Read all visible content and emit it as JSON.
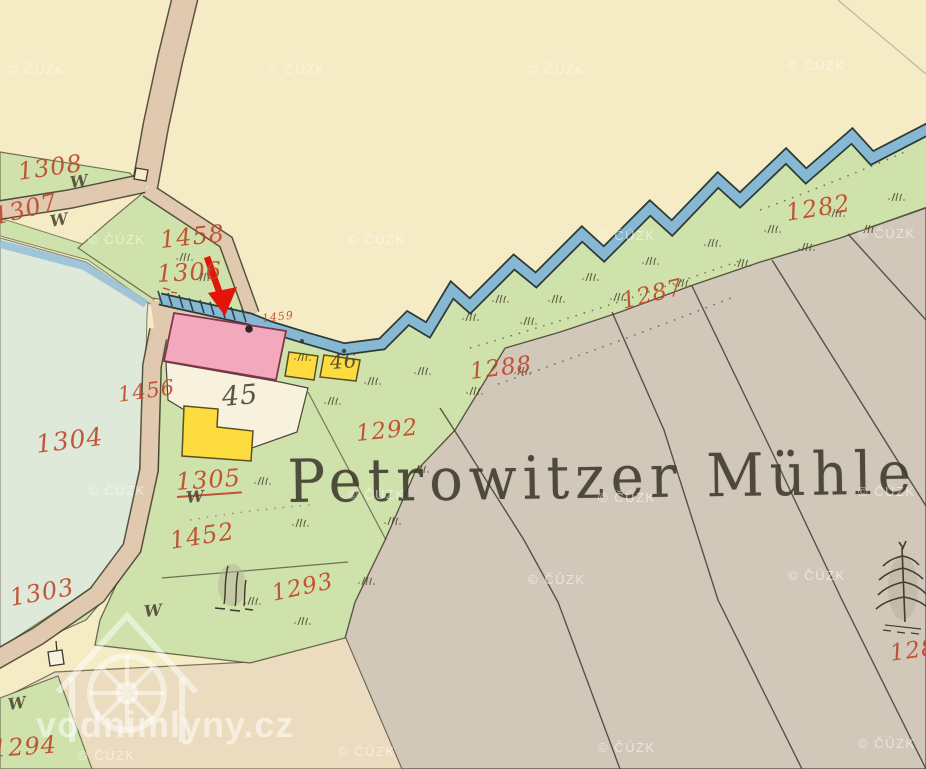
{
  "map": {
    "title_label": "Petrowitzer Mühle",
    "source_watermark": "© ČÚZK",
    "site_watermark": "vodnimlyny.cz",
    "marsh_symbol": "W",
    "parcel_labels": [
      {
        "text": "1308",
        "x": 18,
        "y": 158,
        "rot": -8,
        "size": 24,
        "kind": "red"
      },
      {
        "text": "1307",
        "x": -6,
        "y": 203,
        "rot": -14,
        "size": 24,
        "kind": "red"
      },
      {
        "text": "1458",
        "x": 160,
        "y": 226,
        "rot": -6,
        "size": 24,
        "kind": "red"
      },
      {
        "text": "1306",
        "x": 157,
        "y": 260,
        "rot": -3,
        "size": 24,
        "kind": "red"
      },
      {
        "text": "1459",
        "x": 262,
        "y": 312,
        "rot": -6,
        "size": 11,
        "kind": "red"
      },
      {
        "text": "1456",
        "x": 118,
        "y": 383,
        "rot": -8,
        "size": 21,
        "kind": "red"
      },
      {
        "text": "1304",
        "x": 36,
        "y": 430,
        "rot": -7,
        "size": 25,
        "kind": "red"
      },
      {
        "text": "1305",
        "x": 176,
        "y": 468,
        "rot": -4,
        "size": 24,
        "kind": "red",
        "underline": true
      },
      {
        "text": "1452",
        "x": 170,
        "y": 527,
        "rot": -9,
        "size": 24,
        "kind": "red"
      },
      {
        "text": "1303",
        "x": 10,
        "y": 584,
        "rot": -10,
        "size": 24,
        "kind": "red"
      },
      {
        "text": "1293",
        "x": 272,
        "y": 581,
        "rot": -12,
        "size": 23,
        "kind": "red"
      },
      {
        "text": "1292",
        "x": 356,
        "y": 421,
        "rot": -6,
        "size": 23,
        "kind": "red"
      },
      {
        "text": "1288",
        "x": 470,
        "y": 359,
        "rot": -7,
        "size": 23,
        "kind": "red"
      },
      {
        "text": "1287",
        "x": 622,
        "y": 289,
        "rot": -14,
        "size": 23,
        "kind": "red"
      },
      {
        "text": "1282",
        "x": 786,
        "y": 199,
        "rot": -9,
        "size": 24,
        "kind": "red"
      },
      {
        "text": "128",
        "x": 890,
        "y": 641,
        "rot": -8,
        "size": 23,
        "kind": "red"
      },
      {
        "text": "1294",
        "x": -8,
        "y": 735,
        "rot": -4,
        "size": 24,
        "kind": "red"
      },
      {
        "text": "45",
        "x": 222,
        "y": 382,
        "rot": -5,
        "size": 27,
        "kind": "dark"
      },
      {
        "text": "46",
        "x": 330,
        "y": 350,
        "rot": -4,
        "size": 20,
        "kind": "dark"
      }
    ],
    "marsh_marks": [
      {
        "x": 70,
        "y": 173,
        "rot": -8
      },
      {
        "x": 50,
        "y": 212,
        "rot": -10
      },
      {
        "x": 186,
        "y": 488,
        "rot": -5
      },
      {
        "x": 144,
        "y": 602,
        "rot": -6
      },
      {
        "x": 8,
        "y": 695,
        "rot": -8
      }
    ],
    "watermark_positions": [
      [
        8,
        62
      ],
      [
        268,
        62
      ],
      [
        528,
        62
      ],
      [
        788,
        58
      ],
      [
        88,
        232
      ],
      [
        348,
        232
      ],
      [
        598,
        228
      ],
      [
        858,
        226
      ],
      [
        88,
        483
      ],
      [
        348,
        487
      ],
      [
        598,
        490
      ],
      [
        858,
        484
      ],
      [
        528,
        572
      ],
      [
        788,
        568
      ],
      [
        78,
        748
      ],
      [
        338,
        744
      ],
      [
        598,
        740
      ],
      [
        858,
        736
      ]
    ],
    "annotation": {
      "type": "red-arrow",
      "color": "#e3150b"
    },
    "colors": {
      "paper": "#f5ecc6",
      "paper_warm": "#ecdcbf",
      "meadow": "#cfe2ab",
      "field": "#d2c8ba",
      "pond": "#dee9da",
      "water": "#86b8d4",
      "road": "#e0c9ae",
      "building_masonry": "#f2a9bd",
      "building_wood": "#fcdc3f",
      "label_red": "#bf4a2c",
      "ink": "#3b372b",
      "arrow_red": "#e3150b"
    }
  }
}
